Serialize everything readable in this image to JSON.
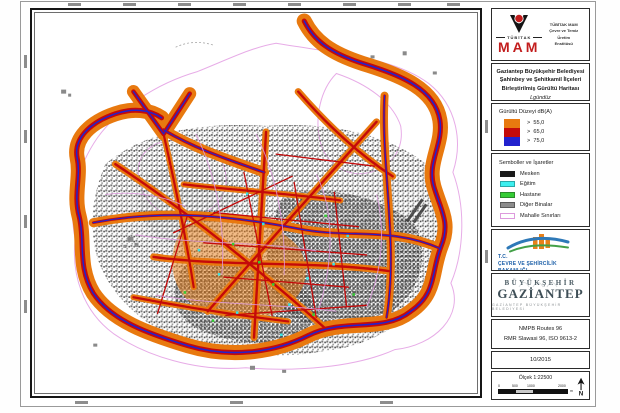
{
  "map_colors": {
    "noise_over_55": "#E8790F",
    "noise_over_65": "#C40A0A",
    "noise_over_75": "#2222CE",
    "district_boundary": "#DD9ADD",
    "city_fabric": "#6F6F6F"
  },
  "panel": {
    "tubitak_box": {
      "logo_icon": "tubitak-emblem-icon",
      "wordmark_small": "TÜBİTAK",
      "wordmark_big": "MAM",
      "wordmark_color": "#C21D1D",
      "institute_line1": "TÜBİTAK MAM",
      "institute_line2": "Çevre ve Temiz Üretim",
      "institute_line3": "Enstitüsü"
    },
    "title_box": {
      "line1": "Gaziantep Büyükşehir Belediyesi",
      "line2": "Şahinbey ve Şehitkamil İlçeleri",
      "line3": "Birleştirilmiş Gürültü Haritası",
      "subtitle": "Lgündüz"
    },
    "noise_legend": {
      "title": "Gürültü Düzeyi dB(A)",
      "entries": [
        {
          "color": "#E8790F",
          "label": ">  55,0"
        },
        {
          "color": "#C40A0A",
          "label": ">  65,0"
        },
        {
          "color": "#2222CE",
          "label": ">  75,0"
        }
      ]
    },
    "symbols_legend": {
      "title": "Semboller ve İşaretler",
      "items": [
        {
          "label": "Mesken",
          "color": "#1A1A1A",
          "border": "#1A1A1A"
        },
        {
          "label": "Eğitim",
          "color": "#3DEFEF",
          "border": "#2AA8A8"
        },
        {
          "label": "Hastane",
          "color": "#35CC35",
          "border": "#2A8A2A"
        },
        {
          "label": "Diğer Binalar",
          "color": "#8C8C8C",
          "border": "#5A5A5A"
        },
        {
          "label": "Mahalle Sınırları",
          "color": "#FFFFFF",
          "border": "#DD9ADD"
        }
      ]
    },
    "ministry_box": {
      "logo_icon": "ministry-buildings-swoosh-icon",
      "line1": "T.C.",
      "line2": "ÇEVRE VE ŞEHİRCİLİK",
      "line3": "BAKANLIĞI",
      "text_color": "#1C5FA8"
    },
    "city_box": {
      "line1": "BÜYÜKŞEHİR",
      "line2": "GAZİANTEP",
      "line3": "GAZİANTEP BÜYÜKŞEHİR BELEDİYESİ"
    },
    "methods_box": {
      "line1": "NMPB Routes 96",
      "line2": "RMR Slawasi 96, ISO 9613-2"
    },
    "date_box": {
      "date": "10/2015"
    },
    "scale_box": {
      "label": "Ölçek 1:22500",
      "ticks": [
        "0",
        "500",
        "1000",
        "2000"
      ],
      "unit": "m",
      "north_icon": "north-arrow-icon",
      "north_label": "N"
    }
  }
}
